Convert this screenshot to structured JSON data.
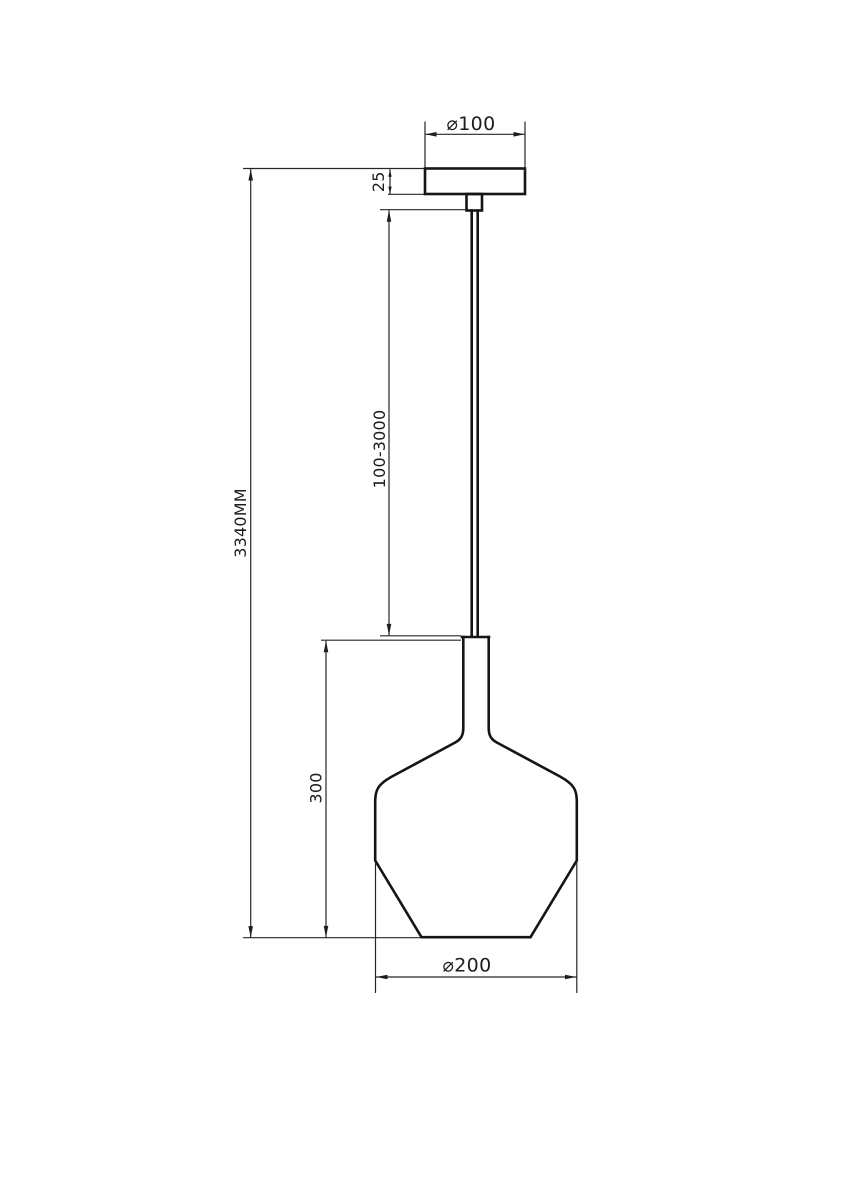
{
  "drawing": {
    "type": "pendant-lamp-technical-dimension-drawing",
    "background_color": "#ffffff",
    "object_line_color": "#151515",
    "dimension_line_color": "#262626",
    "labels": {
      "canopy_diameter": "⌀100",
      "canopy_height": "25",
      "cable_length_range": "100-3000",
      "overall_height": "3340MM",
      "shade_height": "300",
      "shade_diameter": "⌀200"
    }
  }
}
